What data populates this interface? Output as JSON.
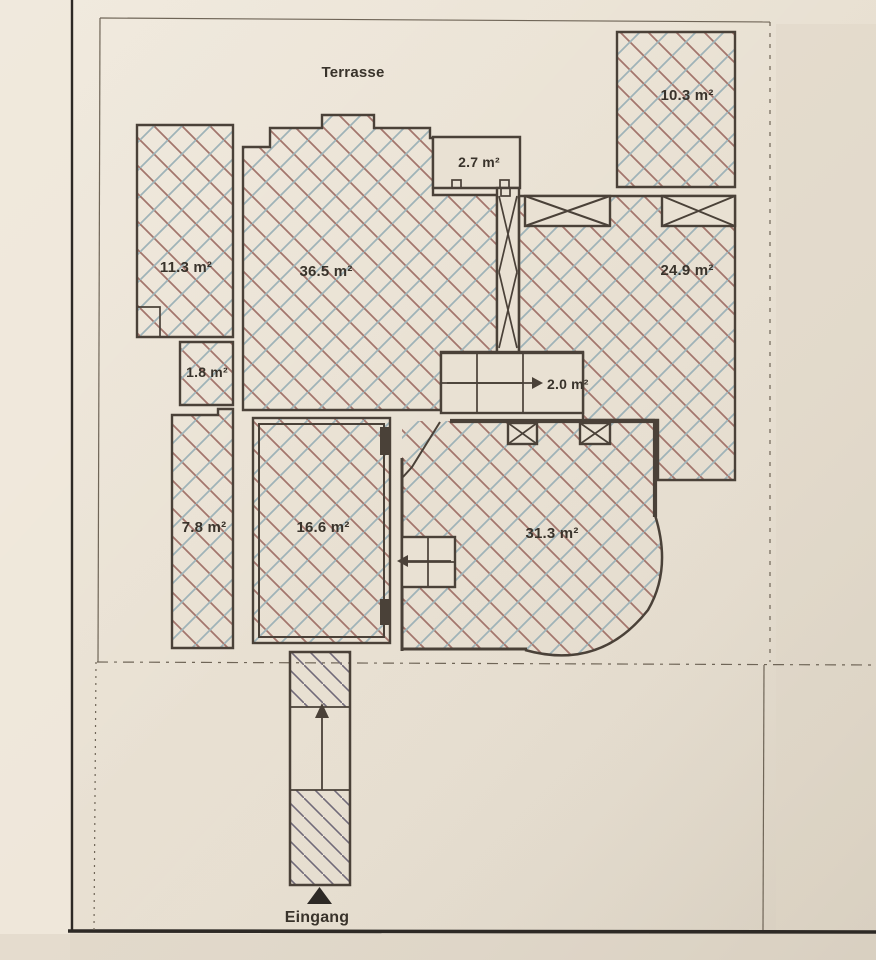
{
  "labels": {
    "terrasse": "Terrasse",
    "eingang": "Eingang"
  },
  "rooms": {
    "r11_3": "11.3 m²",
    "r36_5": "36.5 m²",
    "r2_7": "2.7 m²",
    "r10_3": "10.3 m²",
    "r24_9": "24.9 m²",
    "r1_8": "1.8 m²",
    "r2_0": "2.0 m²",
    "r7_8": "7.8 m²",
    "r16_6": "16.6 m²",
    "r31_3": "31.3 m²"
  },
  "colors": {
    "paper": "#e9e1d3",
    "paper_edge": "#f0e9dc",
    "paper_dark": "#ddd4c5",
    "wall": "#4a4138",
    "ink": "#39332b",
    "boundary": "#6f6557",
    "hatch_red": "#a3766d",
    "hatch_blue": "#9fb3b8",
    "hatch_gray": "#716a79",
    "black": "#2d2925"
  }
}
